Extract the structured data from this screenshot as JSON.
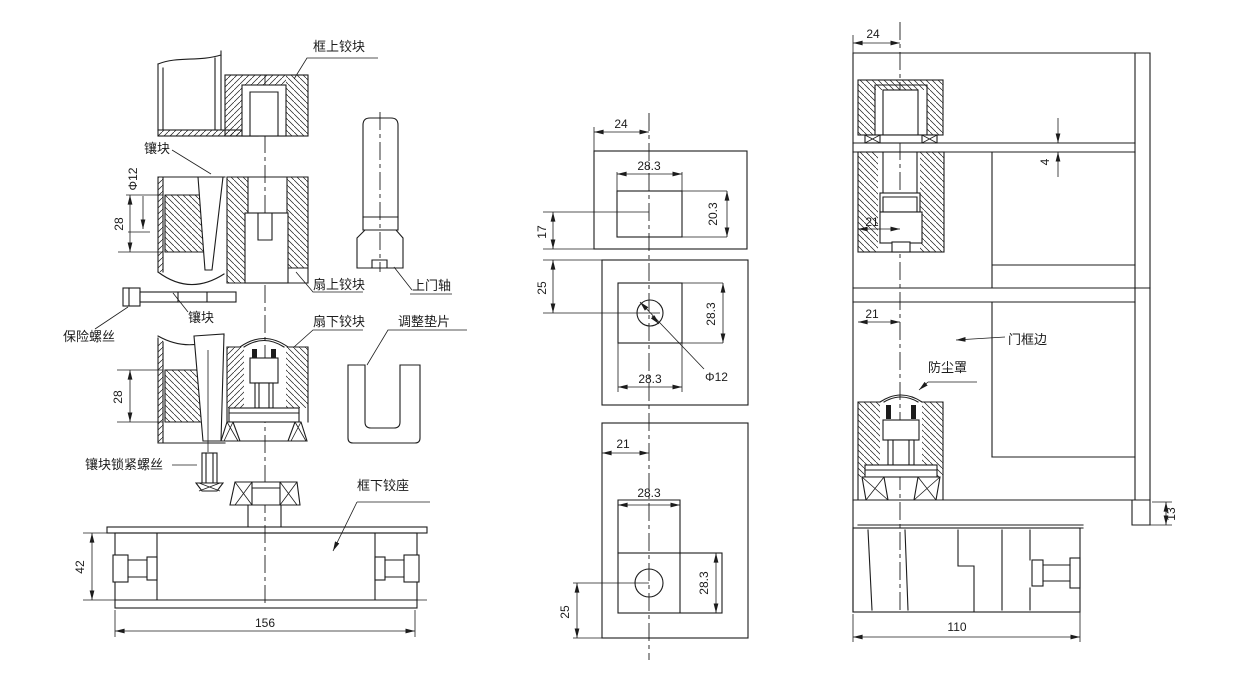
{
  "views": {
    "exploded": {
      "labels": {
        "frame_upper_hinge": "框上铰块",
        "insert_upper": "镶块",
        "safety_screw": "保险螺丝",
        "insert_mid": "镶块",
        "leaf_upper_hinge": "扇上铰块",
        "leaf_lower_hinge": "扇下铰块",
        "adjusting_shim": "调整垫片",
        "upper_door_pivot": "上门轴",
        "insert_lock_screw": "镶块锁紧螺丝",
        "frame_lower_seat": "框下铰座"
      },
      "dims": {
        "pin_diameter": "Φ12",
        "upper_insert_depth": "28",
        "lower_insert_depth": "28",
        "seat_height": "42",
        "seat_width": "156"
      }
    },
    "plates": {
      "dims": {
        "top_edge_offset": "24",
        "top_slot_width": "28.3",
        "top_slot_height": "20.3",
        "top_bottom_margin": "17",
        "mid_top_margin": "25",
        "mid_slot_height": "28.3",
        "mid_slot_width": "28.3",
        "hole_diameter": "Φ12",
        "bottom_edge_offset": "21",
        "bottom_slot_width": "28.3",
        "bottom_slot_height": "28.3",
        "bottom_margin": "25"
      }
    },
    "installed": {
      "labels": {
        "door_frame_edge": "门框边",
        "dust_cover": "防尘罩"
      },
      "dims": {
        "frame_edge_offset": "24",
        "top_gap": "4",
        "upper_pivot_offset": "21",
        "lower_pivot_offset": "21",
        "floor_thickness": "13",
        "seat_width": "110"
      }
    }
  },
  "colors": {
    "line": "#1c1c1c",
    "background": "#ffffff"
  }
}
